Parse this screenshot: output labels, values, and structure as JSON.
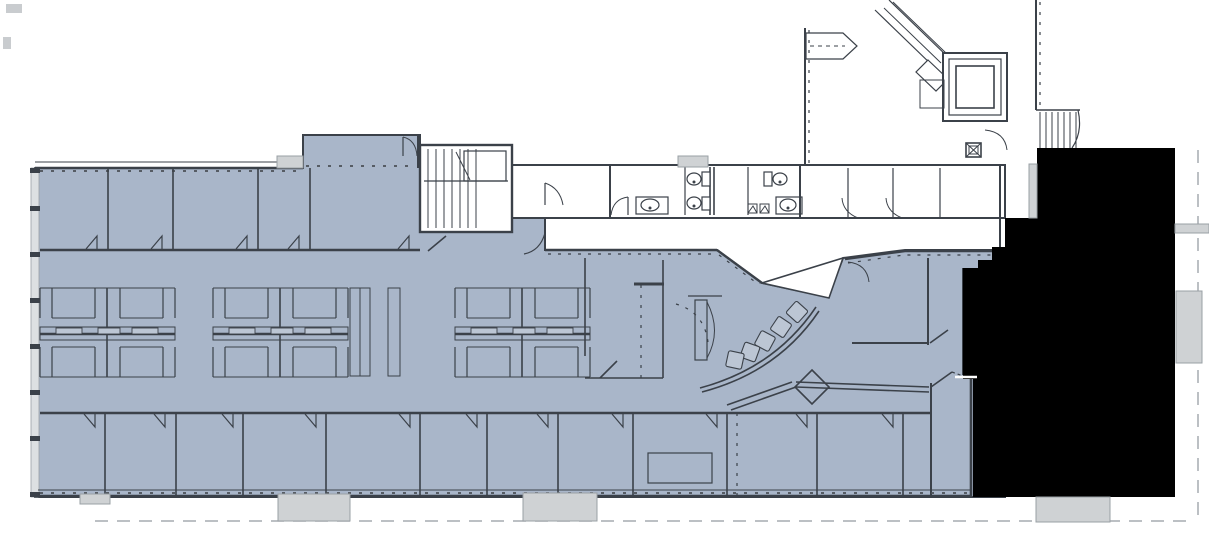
{
  "meta": {
    "title": "Office building floor plan",
    "kind": "architectural-floor-plan",
    "visible_text": "none"
  },
  "colors": {
    "bg": "#ffffff",
    "suite": "#a9b6c9",
    "wall": "#3b4149",
    "ltgray": "#dde0e2",
    "tab": "#cfd2d4",
    "blackout": "#000000",
    "dash": "#a6abb0",
    "chair": "#bcc6d4"
  },
  "plan": {
    "regions": [
      {
        "id": "tenant-suite",
        "kind": "highlighted-available-space",
        "color_ref": "suite"
      },
      {
        "id": "blackout-space",
        "kind": "redacted-neighboring-tenant",
        "color_ref": "blackout"
      },
      {
        "id": "stairwell-west",
        "kind": "core"
      },
      {
        "id": "restrooms",
        "kind": "core"
      },
      {
        "id": "elevator",
        "kind": "core"
      },
      {
        "id": "elevator-lobby",
        "kind": "core"
      },
      {
        "id": "escalator",
        "kind": "core"
      },
      {
        "id": "stairwell-east",
        "kind": "core"
      },
      {
        "id": "reception-waiting-curve",
        "kind": "suite-feature"
      },
      {
        "id": "cubicle-clusters",
        "kind": "suite-feature",
        "count": 3
      },
      {
        "id": "offices-north-row",
        "kind": "suite-feature",
        "count": 5
      },
      {
        "id": "offices-south-row",
        "kind": "suite-feature",
        "count": 12
      }
    ],
    "fixtures": {
      "toilets": 3,
      "sinks": 2,
      "reception_chairs": 5,
      "conference_tables": 1,
      "site_column_tabs": 6
    }
  }
}
